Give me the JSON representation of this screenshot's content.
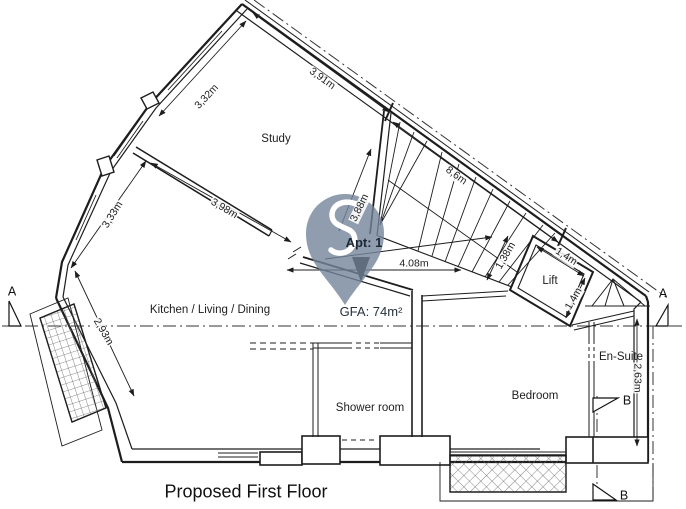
{
  "plan": {
    "title": "Proposed First Floor",
    "apartment_label": "Apt: 1",
    "gfa_label": "GFA: 74m²"
  },
  "rooms": {
    "study": "Study",
    "kitchen_living_dining": "Kitchen / Living / Dining",
    "shower_room": "Shower room",
    "bedroom": "Bedroom",
    "ensuite": "En-Suite",
    "lift": "Lift"
  },
  "dimensions": {
    "study_left_wall": "3,32m",
    "study_top_wall": "3,91m",
    "kitchen_upper_left_wall": "3,33m",
    "study_partition": "3,98m",
    "stair_run": "8,6m",
    "stair_width": "3,88m",
    "stair_landing": "1,38m",
    "lift_width": "1,4m",
    "lift_depth": "1,4m",
    "hallway": "4.08m",
    "kitchen_lower_left_wall": "2,93m",
    "ensuite_wall": "2,63m"
  },
  "section_markers": {
    "a_left": "A",
    "a_right": "A",
    "b_upper": "B",
    "b_lower": "B"
  },
  "icons": {
    "apartment_pin": "location-pin-icon"
  },
  "colors": {
    "line": "#1d1d1d",
    "pin_fill": "#74859B",
    "pin_glyph": "#FFFFFF",
    "label_text": "#1C2836"
  }
}
